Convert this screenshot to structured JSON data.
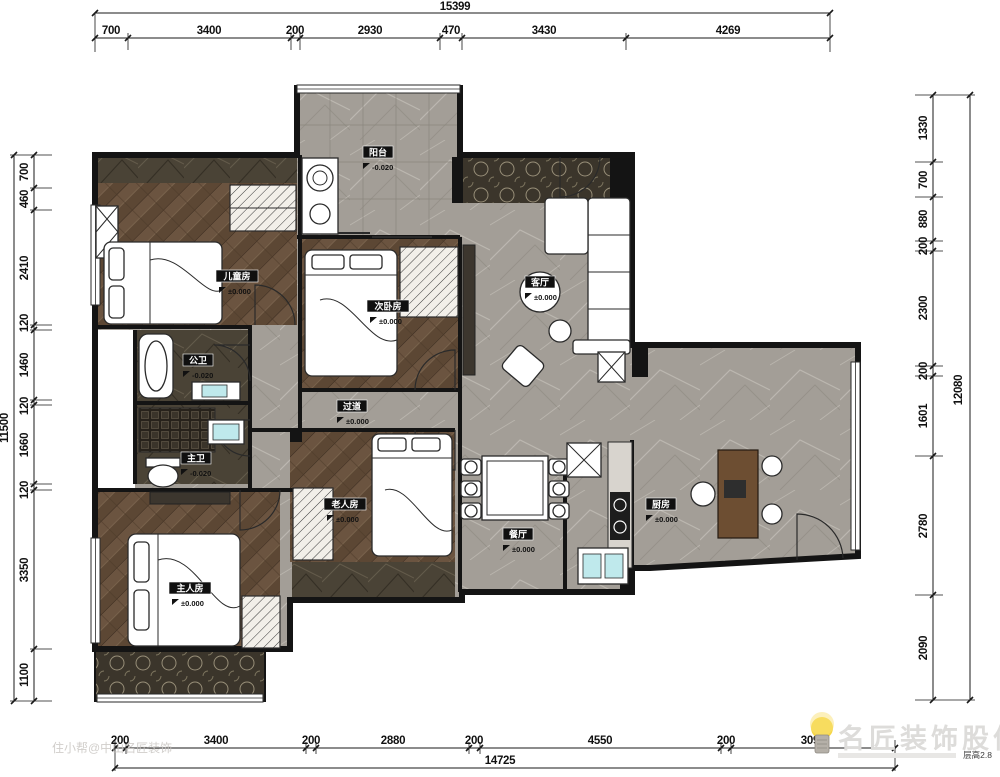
{
  "dimensions": {
    "top": {
      "total": "15399",
      "segments": [
        "700",
        "3400",
        "200",
        "2930",
        "470",
        "3430",
        "4269"
      ]
    },
    "bottom": {
      "total": "14725",
      "segments": [
        "200",
        "3400",
        "200",
        "2880",
        "200",
        "4550",
        "200",
        "3096"
      ]
    },
    "left": {
      "total": "11500",
      "segments": [
        "700",
        "460",
        "2410",
        "120",
        "1460",
        "120",
        "1660",
        "120",
        "3350",
        "1100"
      ]
    },
    "right": {
      "total": "12080",
      "segments": [
        "1330",
        "700",
        "880",
        "200",
        "2300",
        "200",
        "1601",
        "2780",
        "2090"
      ]
    }
  },
  "rooms": [
    {
      "label": "阳台",
      "elevation": "-0.020"
    },
    {
      "label": "儿童房",
      "elevation": "±0.000"
    },
    {
      "label": "次卧房",
      "elevation": "±0.000"
    },
    {
      "label": "客厅",
      "elevation": "±0.000"
    },
    {
      "label": "过道",
      "elevation": "±0.000"
    },
    {
      "label": "公卫",
      "elevation": "-0.020"
    },
    {
      "label": "主卫",
      "elevation": "-0.020"
    },
    {
      "label": "餐厅",
      "elevation": "±0.000"
    },
    {
      "label": "厨房",
      "elevation": "±0.000"
    },
    {
      "label": "老人房",
      "elevation": "±0.000"
    },
    {
      "label": "主人房",
      "elevation": "±0.000"
    }
  ],
  "watermark": {
    "bottom_left": "住小帮@中山名匠装饰",
    "brand": "名匠装饰股份",
    "note": "层高2.8"
  },
  "colors": {
    "wall": "#141414",
    "wood_floor": "#5c4734",
    "tile_floor": "#a29d96",
    "dark_marble": "#4a4337",
    "sink": "#bfe9ec",
    "bulb": "#f4d43a"
  }
}
